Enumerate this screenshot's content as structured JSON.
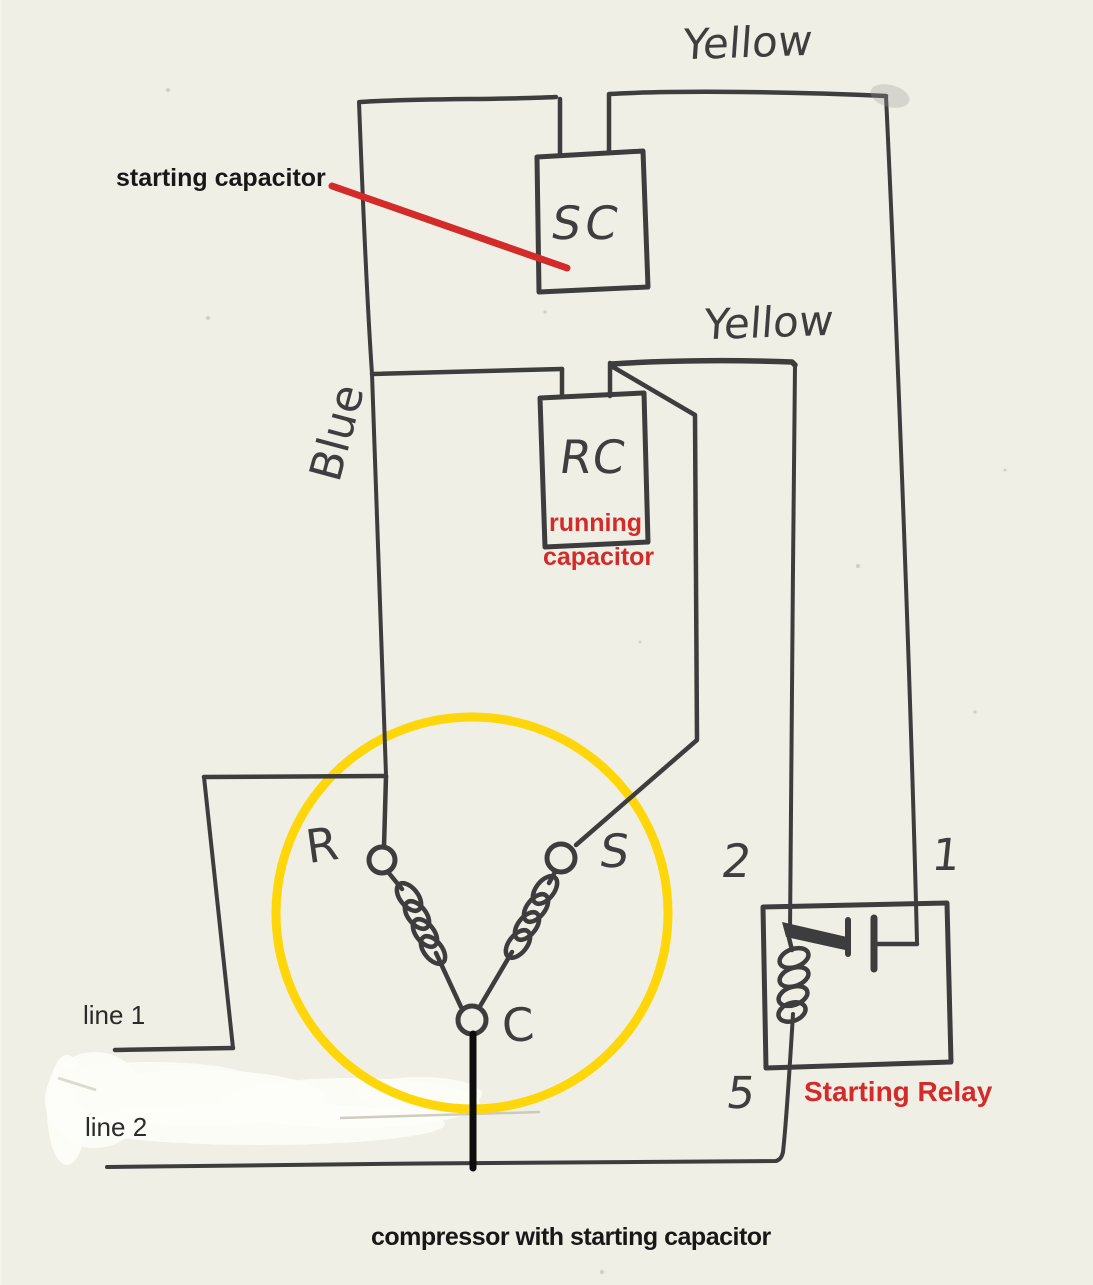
{
  "diagram": {
    "caption": "compressor with starting capacitor",
    "annotations": {
      "starting_capacitor": "starting capacitor",
      "running_line1": "running",
      "running_line2": "capacitor",
      "starting_relay": "Starting Relay"
    },
    "wire_labels": {
      "yellow_top": "Yellow",
      "yellow_mid": "Yellow",
      "blue": "Blue"
    },
    "components": {
      "starting_capacitor_code": "SC",
      "running_capacitor_code": "RC"
    },
    "motor_terminals": {
      "r": "R",
      "s": "S",
      "c": "C"
    },
    "relay_terminals": {
      "t1": "1",
      "t2": "2",
      "t5": "5"
    },
    "power_lines": {
      "line1": "line 1",
      "line2": "line 2"
    },
    "colors": {
      "ink": "#3d3d3d",
      "marker_black": "#0d0d0d",
      "annotation_red": "#d22b2a",
      "motor_circle_yellow": "#ffd60a",
      "paper": "#f3f2e8",
      "whiteout": "#fdfdf8"
    }
  }
}
